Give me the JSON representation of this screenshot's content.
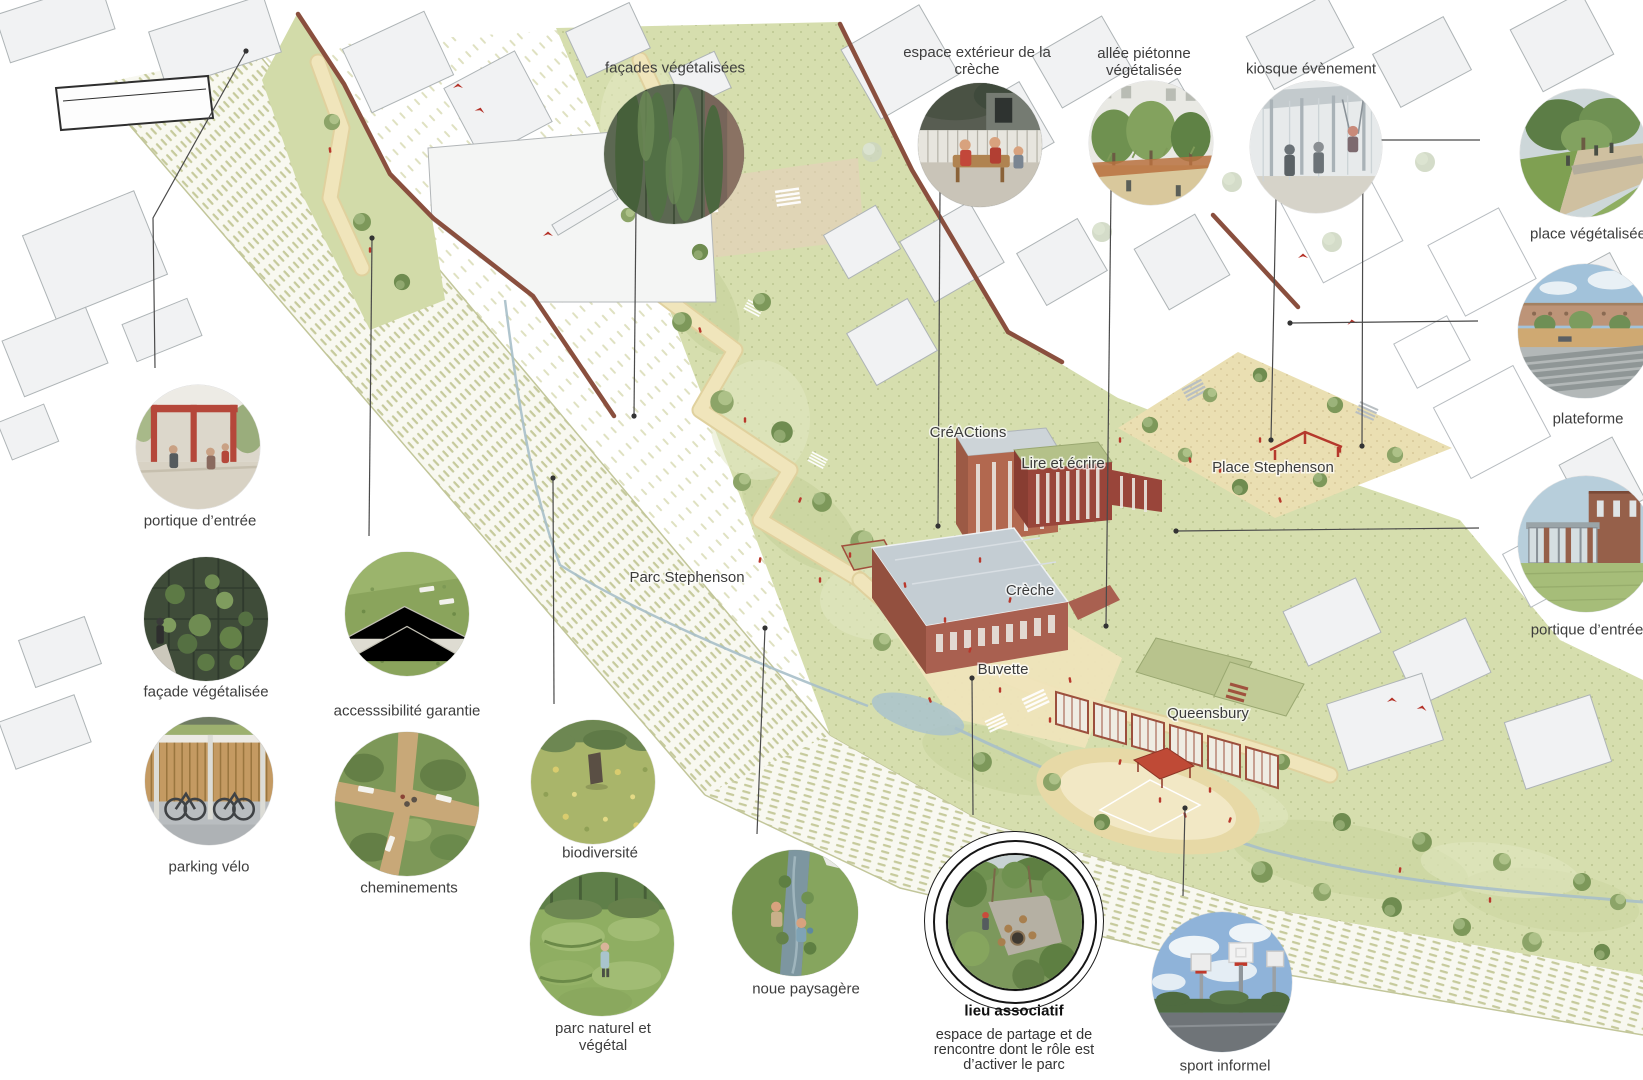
{
  "plan_labels": {
    "creactions": "CréACtions",
    "lire_et_ecrire": "Lire et écrire",
    "place_stephenson": "Place Stephenson",
    "parc_stephenson": "Parc Stephenson",
    "creche": "Crèche",
    "buvette": "Buvette",
    "queensbury": "Queensbury"
  },
  "callouts": {
    "facades_vegetalisees": {
      "label": "façades végétalisées"
    },
    "espace_exterieur_creche": {
      "label": "espace extérieur de la crèche"
    },
    "allee_pietonne": {
      "label": "allée piétonne végétalisée"
    },
    "kiosque_evenement": {
      "label": "kiosque évènement"
    },
    "place_vegetalisee": {
      "label": "place végétalisée"
    },
    "plateforme": {
      "label": "plateforme"
    },
    "portique_entree_droite": {
      "label": "portique d’entrée"
    },
    "portique_entree_gauche": {
      "label": "portique d’entrée"
    },
    "facade_vegetalisee": {
      "label": "façade végétalisée"
    },
    "parking_velo": {
      "label": "parking vélo"
    },
    "accessibilite": {
      "label": "accesssibilité garantie"
    },
    "cheminements": {
      "label": "cheminements"
    },
    "biodiversite": {
      "label": "biodiversité"
    },
    "parc_naturel": {
      "label": "parc naturel et végétal"
    },
    "noue_paysagere": {
      "label": "noue paysagère"
    },
    "lieu_associatif": {
      "title": "lieu associatif",
      "description": "espace de partage et de rencontre dont le rôle est d’activer le parc"
    },
    "sport_informel": {
      "label": "sport informel"
    }
  },
  "colors": {
    "park_green": "#d6deae",
    "path_beige": "#f0e5bb",
    "brick": "#a96050",
    "wall_brick": "#8a4f3e",
    "accent_red": "#b9382c",
    "water_blue": "#a7bfc9",
    "building_grey": "#f1f2f3",
    "text": "#3d3d3d"
  }
}
